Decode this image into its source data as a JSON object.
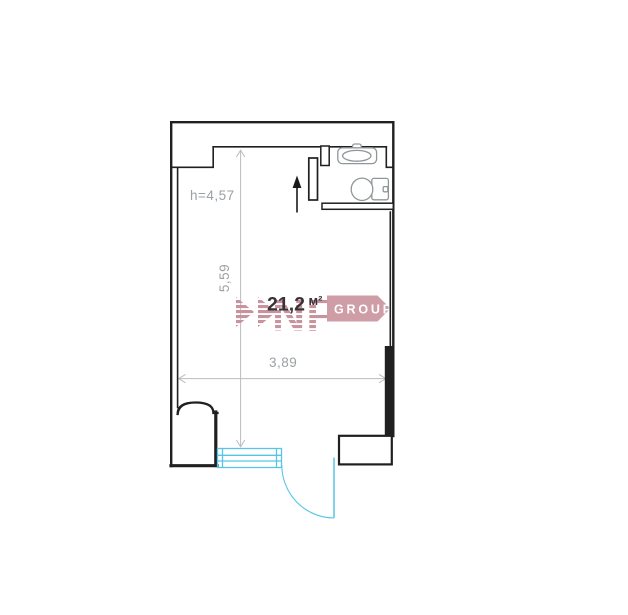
{
  "floor_plan": {
    "area": {
      "value": "21,2",
      "unit": "м²"
    },
    "ceiling_height_label": "h=4,57",
    "dimensions": {
      "vertical": "5,59",
      "horizontal": "3,89"
    },
    "icons": [
      "sink-icon",
      "toilet-icon",
      "up-arrow-icon",
      "door-swing",
      "window"
    ],
    "colors": {
      "wall": "#202020",
      "dimension_line": "#b9bcbe",
      "dimension_text": "#9ba1a4",
      "area_text": "#3a3336",
      "fixture_outline": "#909799",
      "door_window": "#57c6e6",
      "watermark_pink": "#c9939d",
      "banner_pink": "#cf9da6",
      "banner_text": "#ffffff"
    }
  },
  "watermark": {
    "brand": "NF",
    "suffix": "GROUP"
  }
}
